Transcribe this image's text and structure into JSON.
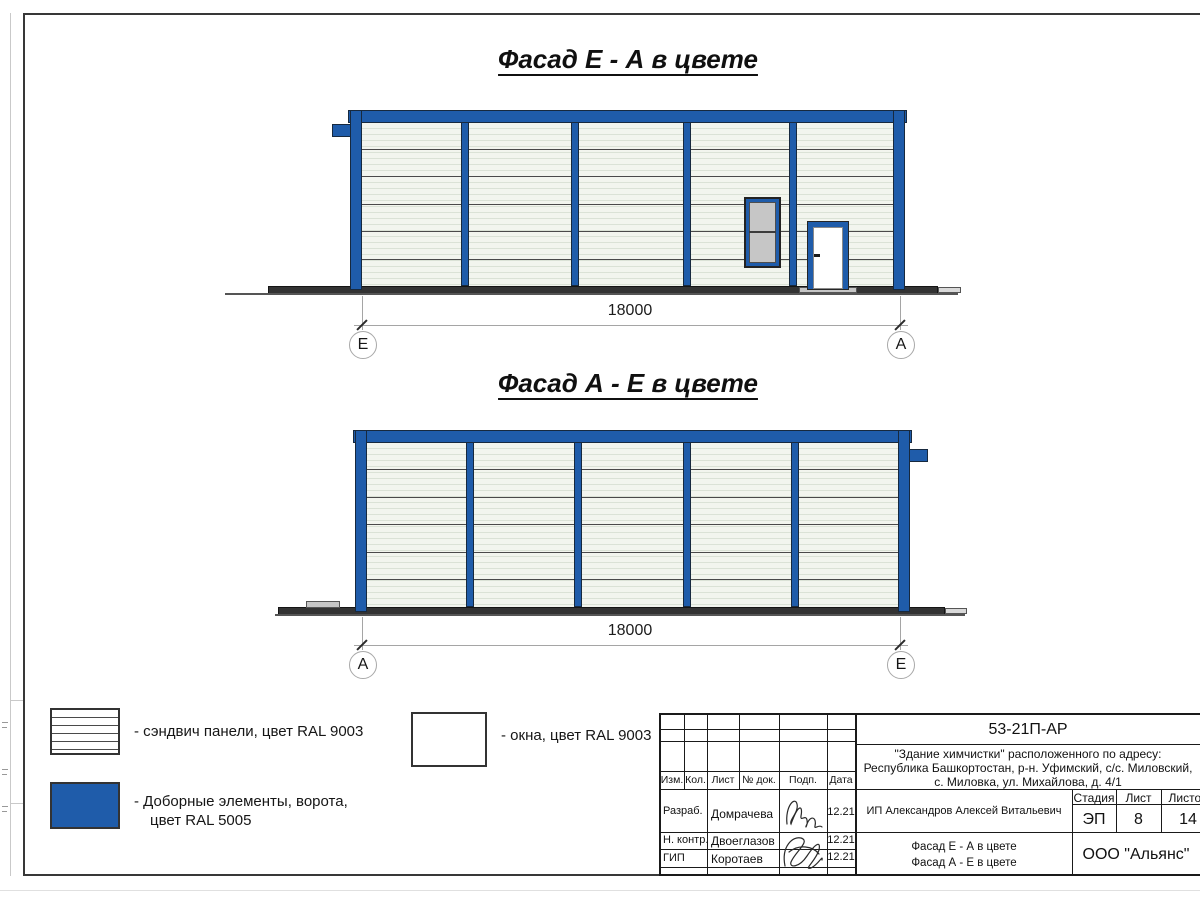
{
  "facade1": {
    "title": "Фасад Е - А в цвете",
    "dimension": "18000",
    "axis_left": "Е",
    "axis_right": "А"
  },
  "facade2": {
    "title": "Фасад А - Е в цвете",
    "dimension": "18000",
    "axis_left": "А",
    "axis_right": "Е"
  },
  "legend": {
    "sandwich_label": "- сэндвич панели, цвет RAL 9003",
    "windows_label": "- окна, цвет RAL 9003",
    "extras_label_line1": "- Доборные элементы, ворота,",
    "extras_label_line2": "цвет RAL 5005"
  },
  "colors": {
    "elements_blue_ral5005": "#1f5caa",
    "panels_ral9003": "#f2f5ee",
    "glass_gray": "#c6c6c6"
  },
  "title_block": {
    "doc_code": "53-21П-АР",
    "address1": "\"Здание химчистки\" расположенного по адресу:",
    "address2": "Республика Башкортостан, р-н. Уфимский, с/с. Миловский,",
    "address3": "с. Миловка, ул. Михайлова, д. 4/1",
    "cols": {
      "izm": "Изм.",
      "kol": "Кол.",
      "list": "Лист",
      "ndok": "№ док.",
      "podp": "Подп.",
      "data": "Дата"
    },
    "rows": [
      {
        "role": "Разраб.",
        "name": "Домрачева",
        "date": "12.21"
      },
      {
        "role": "Н. контр.",
        "name": "Двоеглазов",
        "date": "12.21"
      },
      {
        "role": "ГИП",
        "name": "Коротаев",
        "date": "12.21"
      }
    ],
    "client": "ИП Александров Алексей Витальевич",
    "stage_label": "Стадия",
    "sheet_label": "Лист",
    "sheets_label": "Листов",
    "stage_value": "ЭП",
    "sheet_value": "8",
    "sheets_value": "14",
    "content1": "Фасад Е - А в цвете",
    "content2": "Фасад А - Е в цвете",
    "company": "ООО \"Альянс\""
  }
}
